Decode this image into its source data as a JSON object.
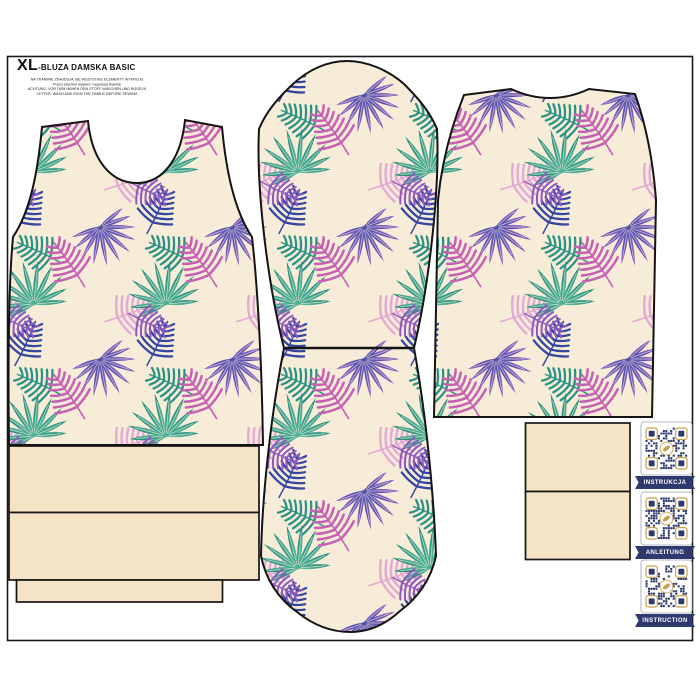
{
  "header": {
    "size": "XL",
    "title": "-BLUZA DAMSKA BASIC",
    "notes": [
      "NA TKANINIE ZNAJDUJĄ SIĘ WSZYSTKIE ELEMENTY WYKROJU",
      "Przed szyciem wypierz i wyprasuj tkaninę",
      "ACHTUNG: VOR DEM NÄHEN DEN STOFF WASCHEN UND BÜGELN",
      "LETTER: WASH AND IRON THE FABRIC BEFORE SEWING"
    ]
  },
  "qr": {
    "items": [
      {
        "label": "INSTRUKCJA"
      },
      {
        "label": "ANLEITUNG"
      },
      {
        "label": "INSTRUCTION"
      }
    ]
  },
  "colors": {
    "cream": "#f7ecd8",
    "beige": "#f4e3c5",
    "outline": "#161616",
    "navy": "#2e3a6e",
    "gold": "#c9a14b",
    "teal": "#2a9284",
    "indigo": "#3246a0",
    "magenta": "#c75fb3",
    "pink_light": "#e4a9d4",
    "purple": "#8f58bf"
  }
}
